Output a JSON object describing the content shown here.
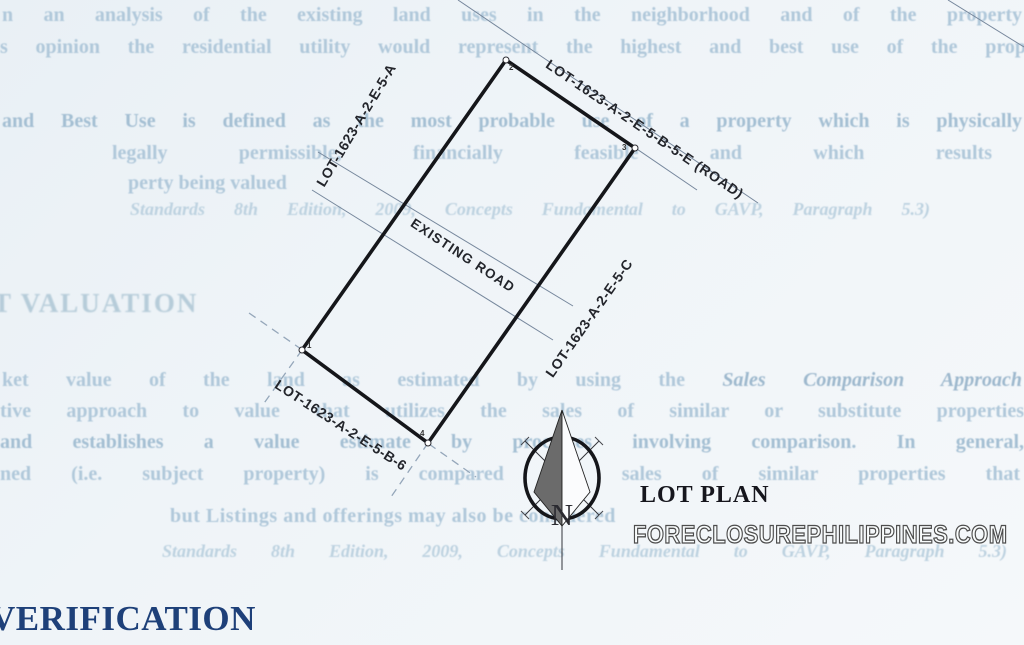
{
  "document": {
    "top_paragraph": {
      "line1": "n an analysis of the existing land uses in the neighborhood and of the property",
      "line2": "s opinion the residential utility would represent the highest and best use of the prop"
    },
    "hbu_paragraph": {
      "line1": "and Best Use is defined as the most probable use of a property which is physically",
      "line2": "legally permissible, financially feasible and which results",
      "line3": "perty being valued",
      "reference": "Standards 8th Edition, 2009, Concepts Fundamental to GAVP, Paragraph 5.3)"
    },
    "valuation_heading": "T VALUATION",
    "valuation_paragraph": {
      "line1a": "ket value of the land as estimated by using the ",
      "line1b": "Sales Comparison Approach",
      "line2": "tive approach to value that utilizes the sales of similar or substitute properties",
      "line3": "and establishes a value estimate by processes involving comparison. In general,",
      "line4": "ned (i.e. subject property) is compared with sales of similar properties that",
      "line5": "but Listings and offerings may also be considered",
      "reference": "Standards 8th Edition, 2009, Concepts Fundamental to GAVP, Paragraph 5.3)"
    },
    "verification_heading": "VERIFICATION"
  },
  "lot_plan": {
    "caption": "LOT PLAN",
    "compass_letter": "N",
    "labels": {
      "road": "LOT-1623-A-2-E-5-B-5-E (ROAD)",
      "lot_a": "LOT-1623-A-2-E-5-A",
      "lot_c": "LOT-1623-A-2-E-5-C",
      "lot_b6": "LOT-1623-A-2-E-5-B-6",
      "existing_road": "EXISTING ROAD"
    },
    "corner_markers": {
      "c1": "1",
      "c2": "2",
      "c3": "3",
      "c4": "4"
    }
  },
  "watermark": "FORECLOSUREPHILIPPINES.COM",
  "colors": {
    "paper": "#eff4f8",
    "ink": "#15161a",
    "faded_text": "#b0c8da",
    "valuation_heading": "#b6ccd9",
    "verification_heading": "#1e4079",
    "thin_line": "#76879c",
    "dashed_line": "#95a7ba",
    "arrow_fill": "#6b6b6b"
  }
}
